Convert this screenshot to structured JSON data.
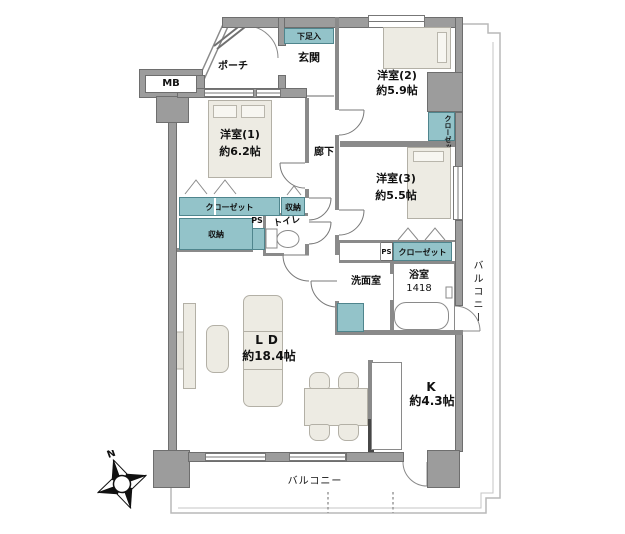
{
  "rooms": {
    "room1": {
      "name": "洋室(1)",
      "size": "約6.2帖"
    },
    "room2": {
      "name": "洋室(2)",
      "size": "約5.9帖"
    },
    "room3": {
      "name": "洋室(3)",
      "size": "約5.5帖"
    },
    "living_dining": {
      "name": "LD",
      "size": "約18.4帖"
    },
    "kitchen": {
      "name": "K",
      "size": "約4.3帖"
    },
    "bathroom": {
      "name": "浴室",
      "size": "1418"
    }
  },
  "labels": {
    "entrance": "玄関",
    "porch": "ポーチ",
    "shoe_cabinet": "下足入",
    "corridor": "廊下",
    "washroom": "洗面室",
    "toilet": "トイレ",
    "meter_box": "MB",
    "pipe_space": "PS",
    "closet": "クローゼット",
    "storage": "収納",
    "balcony": "バルコニー",
    "north": "N"
  },
  "colors": {
    "storage_fill": "#93c3c9",
    "storage_border": "#4f858d",
    "wall_fill": "#9c9c9c",
    "wall_border": "#6e6e6e",
    "furniture_fill": "#edebe3",
    "line": "#787878",
    "balcony_line": "#b9b9b9"
  }
}
